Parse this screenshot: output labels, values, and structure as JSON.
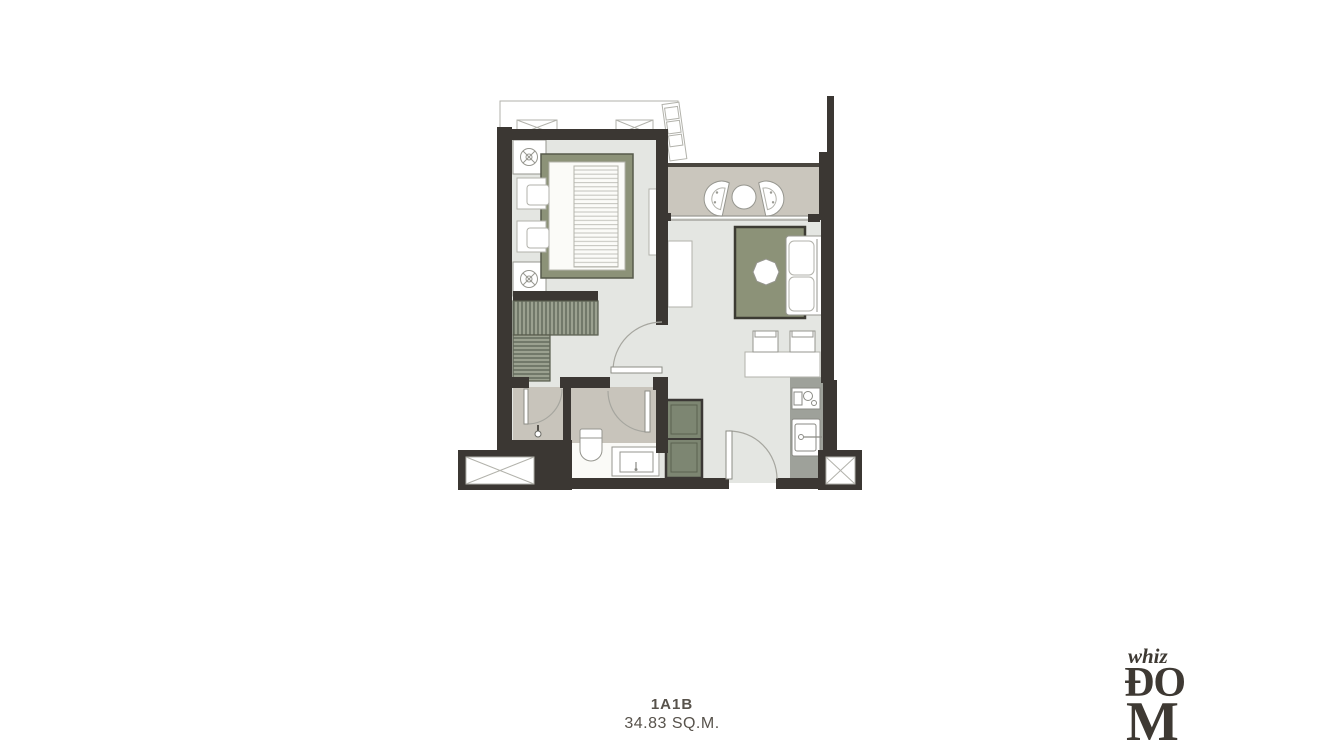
{
  "caption": {
    "unit_name": "1A1B",
    "area": "34.83 SQ.M."
  },
  "logo": {
    "word_top": "whiz",
    "word_mid": "ĐO",
    "word_bottom": "M"
  },
  "colors": {
    "wall": "#3b3733",
    "floor": "#e4e6e2",
    "balcony_floor": "#cac6bd",
    "bathroom_floor": "#c8c4bb",
    "kitchen_floor": "#9ea19a",
    "accent_green": "#8c9278",
    "wardrobe_green": "#9ba190",
    "cabinet_green": "#7d8672",
    "outline": "#96968f",
    "caption_text": "#57524b",
    "logo_text": "#3e3933",
    "page_bg": "#ffffff"
  }
}
